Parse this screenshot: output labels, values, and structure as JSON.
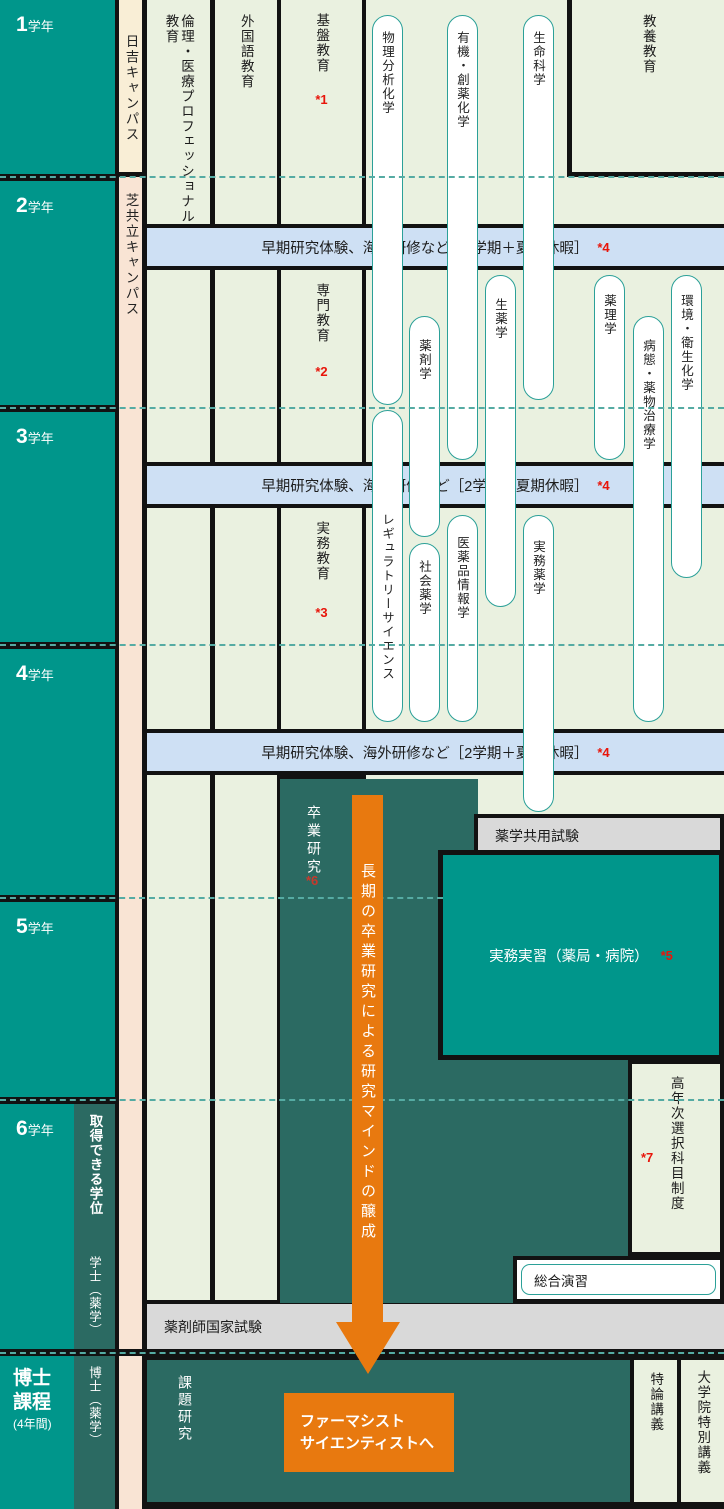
{
  "years": [
    {
      "num": "1",
      "suffix": "学年"
    },
    {
      "num": "2",
      "suffix": "学年"
    },
    {
      "num": "3",
      "suffix": "学年"
    },
    {
      "num": "4",
      "suffix": "学年"
    },
    {
      "num": "5",
      "suffix": "学年"
    },
    {
      "num": "6",
      "suffix": "学年"
    },
    {
      "num": "博士課程",
      "suffix": "(4年間)"
    }
  ],
  "degree": {
    "header": "取得できる学位",
    "bachelor": "学士（薬学）",
    "doctor": "博士（薬学）"
  },
  "campus": {
    "hiyoshi": "日吉キャンパス",
    "shibakyoritsu": "芝共立キャンパス"
  },
  "columns": {
    "ethics": "倫理・医療プロフェッショナル教育",
    "foreign_language": "外国語教育",
    "liberal_arts": "教養教育"
  },
  "stages": {
    "foundation": {
      "label": "基盤教育",
      "note": "*1"
    },
    "specialized": {
      "label": "専門教育",
      "note": "*2"
    },
    "practical": {
      "label": "実務教育",
      "note": "*3"
    },
    "graduation_research": {
      "label": "卒業研究",
      "note": "*6"
    }
  },
  "research_band": {
    "label": "早期研究体験、海外研修など［2学期＋夏期休暇］",
    "note": "*4"
  },
  "pills": [
    "物理分析化学",
    "有機・創薬化学",
    "生命科学",
    "生薬学",
    "薬理学",
    "環境・衛生化学",
    "薬剤学",
    "病態・薬物治療学",
    "レギュラトリーサイエンス",
    "医薬品情報学",
    "実務薬学",
    "社会薬学"
  ],
  "exams": {
    "cbt": "薬学共用試験",
    "national": "薬剤師国家試験"
  },
  "clinical_training": {
    "label": "実務実習（薬局・病院）",
    "note": "*5"
  },
  "senior_elective": {
    "label": "高年次選択科目制度",
    "note": "*7"
  },
  "comprehensive": "総合演習",
  "arrow_text": "長期の卒業研究による研究マインドの醸成",
  "goal": {
    "line1": "ファーマシスト",
    "line2": "サイエンティストへ"
  },
  "doctoral": {
    "research": "課題研究",
    "lecture": "特論講義",
    "special_lecture": "大学院特別講義"
  },
  "colors": {
    "teal": "#00968B",
    "dark_teal": "#2B6A62",
    "light_green": "#EAF1E0",
    "cream": "#F9EED6",
    "pink": "#F9E4D4",
    "band_blue": "#CEE0F4",
    "gray": "#D9D9D9",
    "orange": "#E8790F",
    "note_red": "#E8150A",
    "pill_border": "#2BA098",
    "dash_teal": "#55ABA3",
    "black": "#121212"
  }
}
